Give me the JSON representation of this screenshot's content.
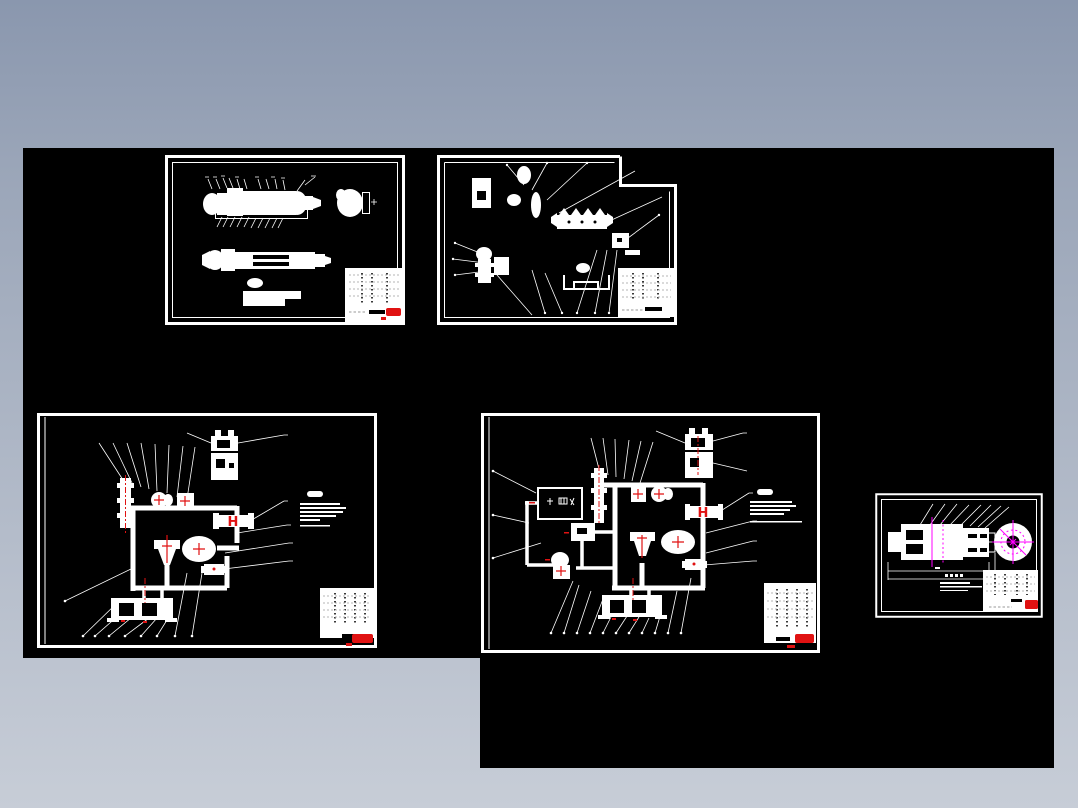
{
  "palette": {
    "bgtop": "#8a97ae",
    "bgbottom": "#c7cdd7",
    "canvas": "#000000",
    "line": "#ffffff",
    "red": "#e01212",
    "magenta": "#ff00ff",
    "tableink": "#3a3a3a",
    "tablelight": "#b5b5b5"
  },
  "markers": {
    "h": "H"
  },
  "workspace": {
    "sheet_count": "5",
    "sheets": [
      {
        "id": "sheet-1",
        "kind": "assembly-views",
        "seal": "red-seal"
      },
      {
        "id": "sheet-2",
        "kind": "parts-schematic",
        "seal": "none"
      },
      {
        "id": "sheet-3",
        "kind": "hydraulic-circuit-a",
        "marker": "H",
        "seal": "red-seal"
      },
      {
        "id": "sheet-4",
        "kind": "hydraulic-circuit-b",
        "marker": "H",
        "seal": "red-seal"
      },
      {
        "id": "sheet-5",
        "kind": "coupling-detail",
        "seal": "red-seal"
      }
    ]
  }
}
